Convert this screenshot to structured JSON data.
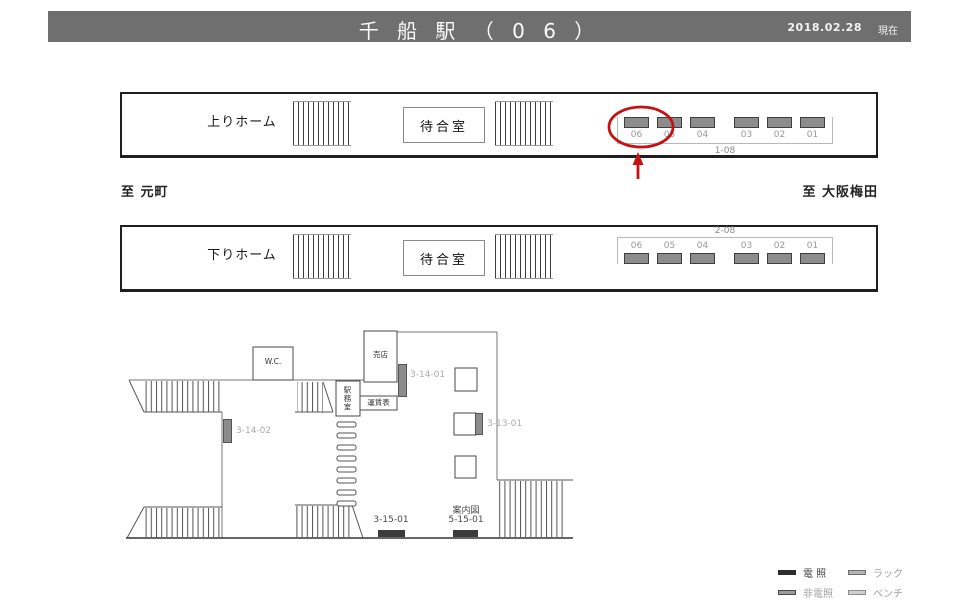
{
  "header": {
    "title": "千 船 駅 （ 0 6 ）",
    "date": "2018.02.28",
    "as_of": "現在"
  },
  "directions": {
    "left": "至 元町",
    "right": "至 大阪梅田"
  },
  "platforms": {
    "upper": {
      "name": "上りホーム",
      "waiting_room": "待合室",
      "group_label": "1-08",
      "positions": [
        "06",
        "05",
        "04",
        "03",
        "02",
        "01"
      ],
      "highlighted_position": "06"
    },
    "lower": {
      "name": "下りホーム",
      "waiting_room": "待合室",
      "group_label": "2-08",
      "positions": [
        "06",
        "05",
        "04",
        "03",
        "02",
        "01"
      ]
    }
  },
  "concourse": {
    "wc_label": "W.C.",
    "kiosk_label": "売店",
    "office_label": "駅務室",
    "fare_table_label": "運賃表",
    "guide_map_label": "案内図",
    "ad_ids": {
      "a31401": "3-14-01",
      "a31402": "3-14-02",
      "a31301": "3-13-01",
      "a31501": "3-15-01",
      "a51501": "5-15-01"
    }
  },
  "legend": {
    "items": [
      {
        "label": "電 照",
        "type": "lit"
      },
      {
        "label": "ラック",
        "type": "rack"
      },
      {
        "label": "非電照",
        "type": "unlit"
      },
      {
        "label": "ベンチ",
        "type": "bench"
      }
    ]
  },
  "colors": {
    "header_bg": "#6f6f6f",
    "ad_fill": "#8c8c8c",
    "ad_border": "#3f3f3f",
    "lit_fill": "#2e2e2e",
    "highlight_red": "#c51111"
  }
}
